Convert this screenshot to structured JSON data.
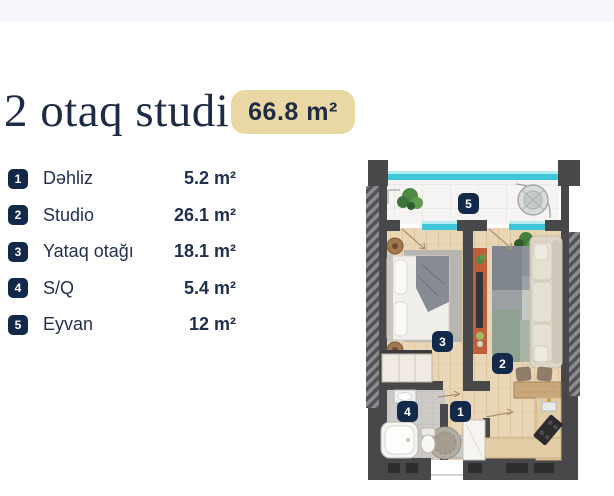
{
  "header": {
    "title": "2 otaq studio",
    "area_badge": "66.8 m²"
  },
  "legend": {
    "items": [
      {
        "num": "1",
        "label": "Dəhliz",
        "area": "5.2 m²"
      },
      {
        "num": "2",
        "label": "Studio",
        "area": "26.1 m²"
      },
      {
        "num": "3",
        "label": "Yataq otağı",
        "area": "18.1 m²"
      },
      {
        "num": "4",
        "label": "S/Q",
        "area": "5.4 m²"
      },
      {
        "num": "5",
        "label": "Eyvan",
        "area": "12 m²"
      }
    ]
  },
  "floorplan": {
    "markers": [
      {
        "num": "1",
        "room": "Dəhliz"
      },
      {
        "num": "2",
        "room": "Studio"
      },
      {
        "num": "3",
        "room": "Yataq otağı"
      },
      {
        "num": "4",
        "room": "S/Q"
      },
      {
        "num": "5",
        "room": "Eyvan"
      }
    ],
    "colors": {
      "wall": "#48484b",
      "glass": "#3fc6d8",
      "wood_floor": "#e8d5b5",
      "tile_floor": "#f5f4f2",
      "bath_floor": "#cdcac7",
      "marker_bg": "#13294a",
      "accent_tan": "#e9d8a4",
      "navy": "#1e2b45"
    }
  }
}
